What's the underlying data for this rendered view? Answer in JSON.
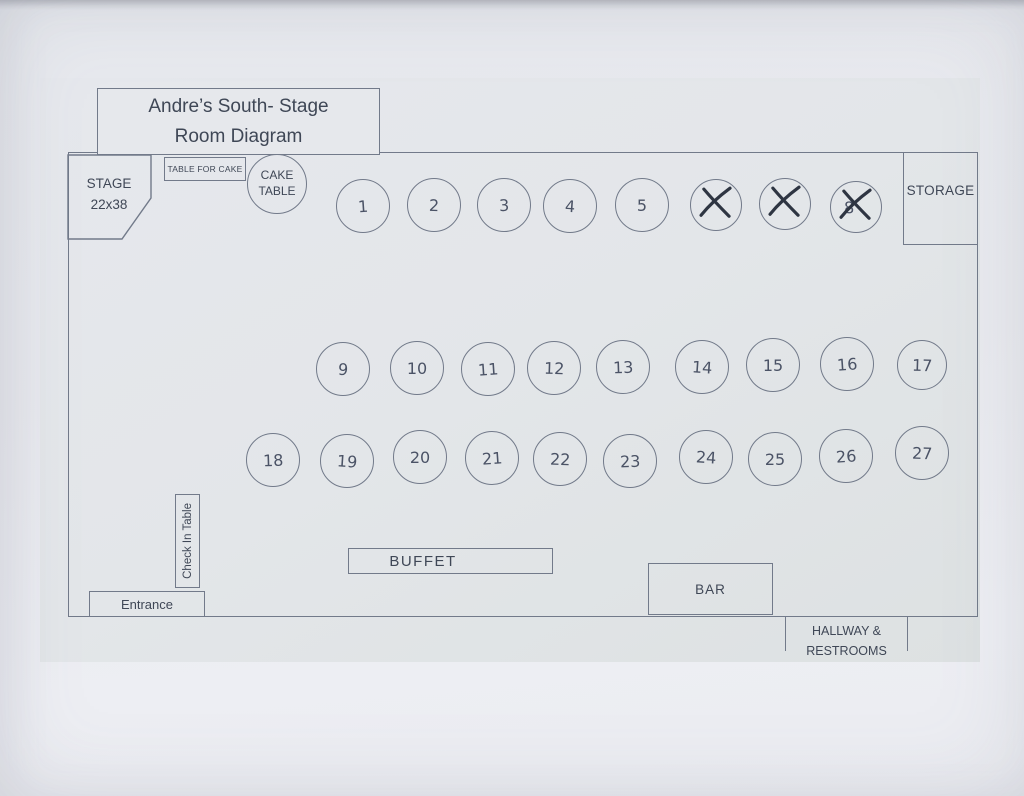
{
  "title": {
    "line1": "Andre’s South- Stage",
    "line2": "Room Diagram"
  },
  "stage": {
    "name": "STAGE",
    "dimensions": "22x38"
  },
  "cake_table_rect": {
    "label": "TABLE FOR CAKE"
  },
  "cake_table_circle": {
    "line1": "CAKE",
    "line2": "TABLE"
  },
  "storage": {
    "label": "STORAGE"
  },
  "check_in": {
    "label": "Check In Table"
  },
  "entrance": {
    "label": "Entrance"
  },
  "buffet": {
    "label": "BUFFET"
  },
  "bar": {
    "label": "BAR"
  },
  "hallway": {
    "line1": "HALLWAY &",
    "line2": "RESTROOMS"
  },
  "colors": {
    "line": "#727a8a",
    "printed_text": "#3f4756",
    "handwriting": "#4b5366",
    "cross_mark": "#2e3542",
    "paper": "#e9eaef",
    "content_background": "#e2e5e8"
  },
  "tables": [
    {
      "n": "1",
      "x": 363,
      "y": 206,
      "crossed": false
    },
    {
      "n": "2",
      "x": 434,
      "y": 205,
      "crossed": false
    },
    {
      "n": "3",
      "x": 504,
      "y": 205,
      "crossed": false
    },
    {
      "n": "4",
      "x": 570,
      "y": 206,
      "crossed": false
    },
    {
      "n": "5",
      "x": 642,
      "y": 205,
      "crossed": false
    },
    {
      "n": "6",
      "x": 716,
      "y": 205,
      "crossed": true,
      "number_visible": false,
      "r": 26
    },
    {
      "n": "7",
      "x": 785,
      "y": 204,
      "crossed": true,
      "number_visible": false,
      "r": 26
    },
    {
      "n": "8",
      "x": 856,
      "y": 207,
      "crossed": true,
      "number_visible": true,
      "dx": -7,
      "r": 26
    },
    {
      "n": "9",
      "x": 343,
      "y": 369,
      "crossed": false
    },
    {
      "n": "10",
      "x": 417,
      "y": 368,
      "crossed": false
    },
    {
      "n": "11",
      "x": 488,
      "y": 369,
      "crossed": false
    },
    {
      "n": "12",
      "x": 554,
      "y": 368,
      "crossed": false
    },
    {
      "n": "13",
      "x": 623,
      "y": 367,
      "crossed": false
    },
    {
      "n": "14",
      "x": 702,
      "y": 367,
      "crossed": false
    },
    {
      "n": "15",
      "x": 773,
      "y": 365,
      "crossed": false
    },
    {
      "n": "16",
      "x": 847,
      "y": 364,
      "crossed": false
    },
    {
      "n": "17",
      "x": 922,
      "y": 365,
      "crossed": false,
      "r": 25
    },
    {
      "n": "18",
      "x": 273,
      "y": 460,
      "crossed": false
    },
    {
      "n": "19",
      "x": 347,
      "y": 461,
      "crossed": false
    },
    {
      "n": "20",
      "x": 420,
      "y": 457,
      "crossed": false
    },
    {
      "n": "21",
      "x": 492,
      "y": 458,
      "crossed": false
    },
    {
      "n": "22",
      "x": 560,
      "y": 459,
      "crossed": false
    },
    {
      "n": "23",
      "x": 630,
      "y": 461,
      "crossed": false
    },
    {
      "n": "24",
      "x": 706,
      "y": 457,
      "crossed": false
    },
    {
      "n": "25",
      "x": 775,
      "y": 459,
      "crossed": false
    },
    {
      "n": "26",
      "x": 846,
      "y": 456,
      "crossed": false
    },
    {
      "n": "27",
      "x": 922,
      "y": 453,
      "crossed": false
    }
  ]
}
